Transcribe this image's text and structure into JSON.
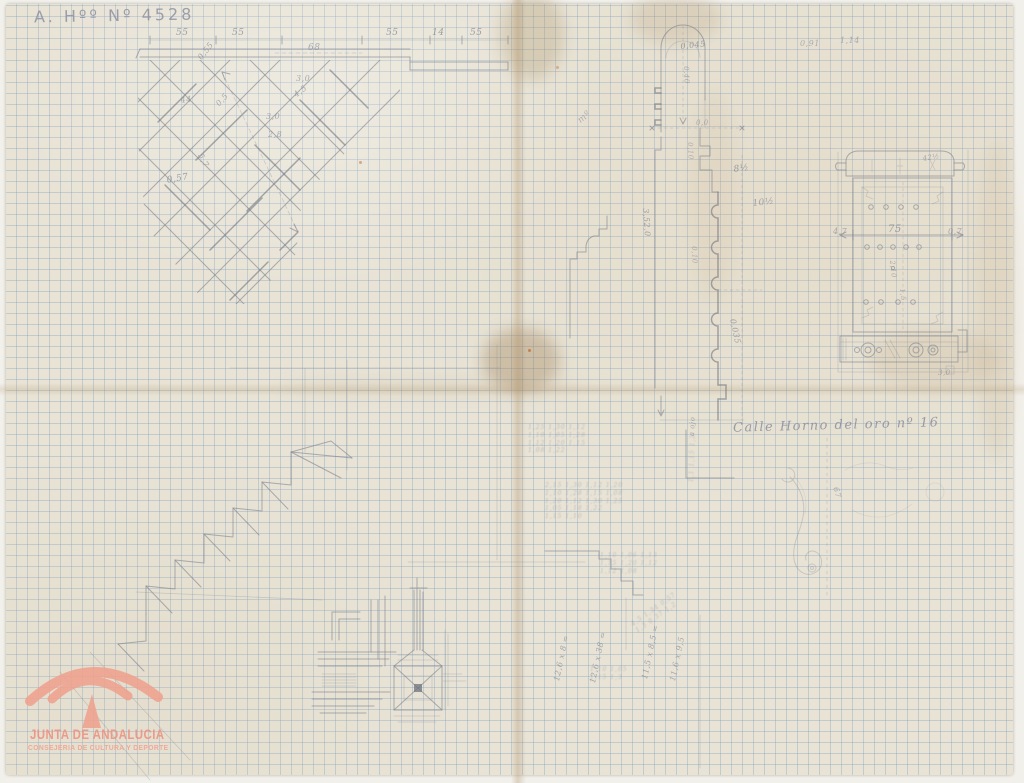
{
  "document": {
    "archive_number": "A. Hºº Nº 4528",
    "street_caption": "Calle Horno del oro nº 16",
    "logo": {
      "org": "JUNTA DE ANDALUCIA",
      "dept": "CONSEJERIA DE CULTURA Y DEPORTE",
      "color": "#ef9f8d"
    },
    "paper_color": "#e8e3d5",
    "grid_color": "#7a9cbc",
    "pencil_color": "#80858f"
  },
  "annotations": [
    {
      "text": "55",
      "x": 176,
      "y": 28,
      "fs": 9,
      "op": 0.7
    },
    {
      "text": "55",
      "x": 232,
      "y": 28,
      "fs": 9,
      "op": 0.7
    },
    {
      "text": "68",
      "x": 308,
      "y": 43,
      "fs": 9,
      "op": 0.6
    },
    {
      "text": "55",
      "x": 386,
      "y": 28,
      "fs": 9,
      "op": 0.7
    },
    {
      "text": "14",
      "x": 432,
      "y": 28,
      "fs": 9,
      "op": 0.7
    },
    {
      "text": "55",
      "x": 470,
      "y": 28,
      "fs": 9,
      "op": 0.7
    },
    {
      "text": "0,55",
      "x": 196,
      "y": 56,
      "fs": 8,
      "rot": -52,
      "op": 0.65
    },
    {
      "text": "44",
      "x": 180,
      "y": 96,
      "fs": 8,
      "rot": -8,
      "op": 0.6
    },
    {
      "text": "0,5",
      "x": 214,
      "y": 102,
      "fs": 8,
      "rot": -48,
      "op": 0.6
    },
    {
      "text": "0,57",
      "x": 166,
      "y": 176,
      "fs": 9,
      "rot": -10,
      "op": 0.7
    },
    {
      "text": "5,7",
      "x": 204,
      "y": 152,
      "fs": 8,
      "rot": 62,
      "op": 0.6
    },
    {
      "text": "3,0",
      "x": 296,
      "y": 74,
      "fs": 8,
      "op": 0.6
    },
    {
      "text": "4,5",
      "x": 292,
      "y": 92,
      "fs": 8,
      "rot": -38,
      "op": 0.6
    },
    {
      "text": "3,0",
      "x": 266,
      "y": 112,
      "fs": 8,
      "op": 0.6
    },
    {
      "text": "2,8",
      "x": 268,
      "y": 130,
      "fs": 8,
      "op": 0.6
    },
    {
      "text": "mº",
      "x": 576,
      "y": 118,
      "fs": 9,
      "rot": -40,
      "op": 0.5
    },
    {
      "text": "0,045",
      "x": 680,
      "y": 42,
      "fs": 8,
      "rot": -6,
      "op": 0.7
    },
    {
      "text": "0,40",
      "x": 690,
      "y": 66,
      "fs": 7,
      "rot": 88,
      "op": 0.55
    },
    {
      "text": "0,0",
      "x": 696,
      "y": 119,
      "fs": 7,
      "op": 0.55
    },
    {
      "text": "8½",
      "x": 733,
      "y": 165,
      "fs": 9,
      "rot": -8,
      "op": 0.7
    },
    {
      "text": "10½",
      "x": 752,
      "y": 199,
      "fs": 9,
      "rot": -6,
      "op": 0.65
    },
    {
      "text": "3,52,0",
      "x": 650,
      "y": 208,
      "fs": 8,
      "rot": 86,
      "op": 0.7
    },
    {
      "text": "0,10",
      "x": 694,
      "y": 142,
      "fs": 7,
      "rot": 88,
      "op": 0.5
    },
    {
      "text": "0,10",
      "x": 698,
      "y": 246,
      "fs": 7,
      "rot": 88,
      "op": 0.5
    },
    {
      "text": "0,035",
      "x": 737,
      "y": 318,
      "fs": 8,
      "rot": 78,
      "op": 0.65
    },
    {
      "text": "0,91",
      "x": 800,
      "y": 39,
      "fs": 8,
      "op": 0.55
    },
    {
      "text": "1,14",
      "x": 840,
      "y": 36,
      "fs": 8,
      "op": 0.55
    },
    {
      "text": "42½",
      "x": 922,
      "y": 155,
      "fs": 7,
      "rot": -10,
      "op": 0.6
    },
    {
      "text": "4,7",
      "x": 833,
      "y": 227,
      "fs": 8,
      "op": 0.6
    },
    {
      "text": "75",
      "x": 888,
      "y": 224,
      "fs": 10,
      "op": 0.72
    },
    {
      "text": "0,7",
      "x": 948,
      "y": 227,
      "fs": 8,
      "op": 0.6
    },
    {
      "text": "2,10",
      "x": 896,
      "y": 260,
      "fs": 7,
      "rot": 84,
      "op": 0.55
    },
    {
      "text": "1,5",
      "x": 906,
      "y": 288,
      "fs": 7,
      "rot": 84,
      "op": 0.5
    },
    {
      "text": "3,0",
      "x": 938,
      "y": 369,
      "fs": 7,
      "op": 0.55
    },
    {
      "text": "67",
      "x": 840,
      "y": 486,
      "fs": 8,
      "rot": 75,
      "op": 0.55
    },
    {
      "text": "a ojo",
      "x": 688,
      "y": 436,
      "fs": 7,
      "rot": -88,
      "op": 0.6
    },
    {
      "text": "12,6 x 8 =",
      "x": 552,
      "y": 680,
      "fs": 8,
      "rot": -78,
      "op": 0.65
    },
    {
      "text": "12,6 x 38 =",
      "x": 588,
      "y": 682,
      "fs": 8,
      "rot": -78,
      "op": 0.65
    },
    {
      "text": "11,5 x 8,5 =",
      "x": 640,
      "y": 678,
      "fs": 8,
      "rot": -78,
      "op": 0.65
    },
    {
      "text": "11,6 x 9,5",
      "x": 668,
      "y": 680,
      "fs": 8,
      "rot": -78,
      "op": 0.6
    }
  ],
  "scribbles": [
    {
      "x": 528,
      "y": 424,
      "fs": 6,
      "op": 0.45,
      "rot": 0,
      "lines": [
        "1,25 1,30 1,12",
        "1,10 1,05 1,28",
        "1,12 1,20 1,15",
        "1,08 1,22"
      ]
    },
    {
      "x": 545,
      "y": 482,
      "fs": 6,
      "op": 0.45,
      "rot": 0,
      "lines": [
        "2,15 1,30 1,12 1,20",
        "1,10 1,28 1,15 1,08",
        "1,20 1,12 1,30 1,25",
        "1,05 1,18 1,22",
        "1,15 1,10"
      ]
    },
    {
      "x": 600,
      "y": 552,
      "fs": 6,
      "op": 0.42,
      "rot": 0,
      "lines": [
        "1,10 1,06 1,13",
        "1,15 1,20 1,12",
        "1,12 1,08"
      ]
    },
    {
      "x": 630,
      "y": 622,
      "fs": 6,
      "op": 0.45,
      "rot": -35,
      "lines": [
        "4,5 1,34 0,57",
        "1,3 0,37 1,2"
      ]
    },
    {
      "x": 590,
      "y": 666,
      "fs": 6,
      "op": 0.42,
      "rot": 0,
      "lines": [
        "1,10 1,05",
        "1,15 1,3"
      ]
    },
    {
      "x": 688,
      "y": 482,
      "fs": 6,
      "op": 0.4,
      "rot": -88,
      "lines": [
        "1,1 1,15 1,2"
      ]
    }
  ]
}
